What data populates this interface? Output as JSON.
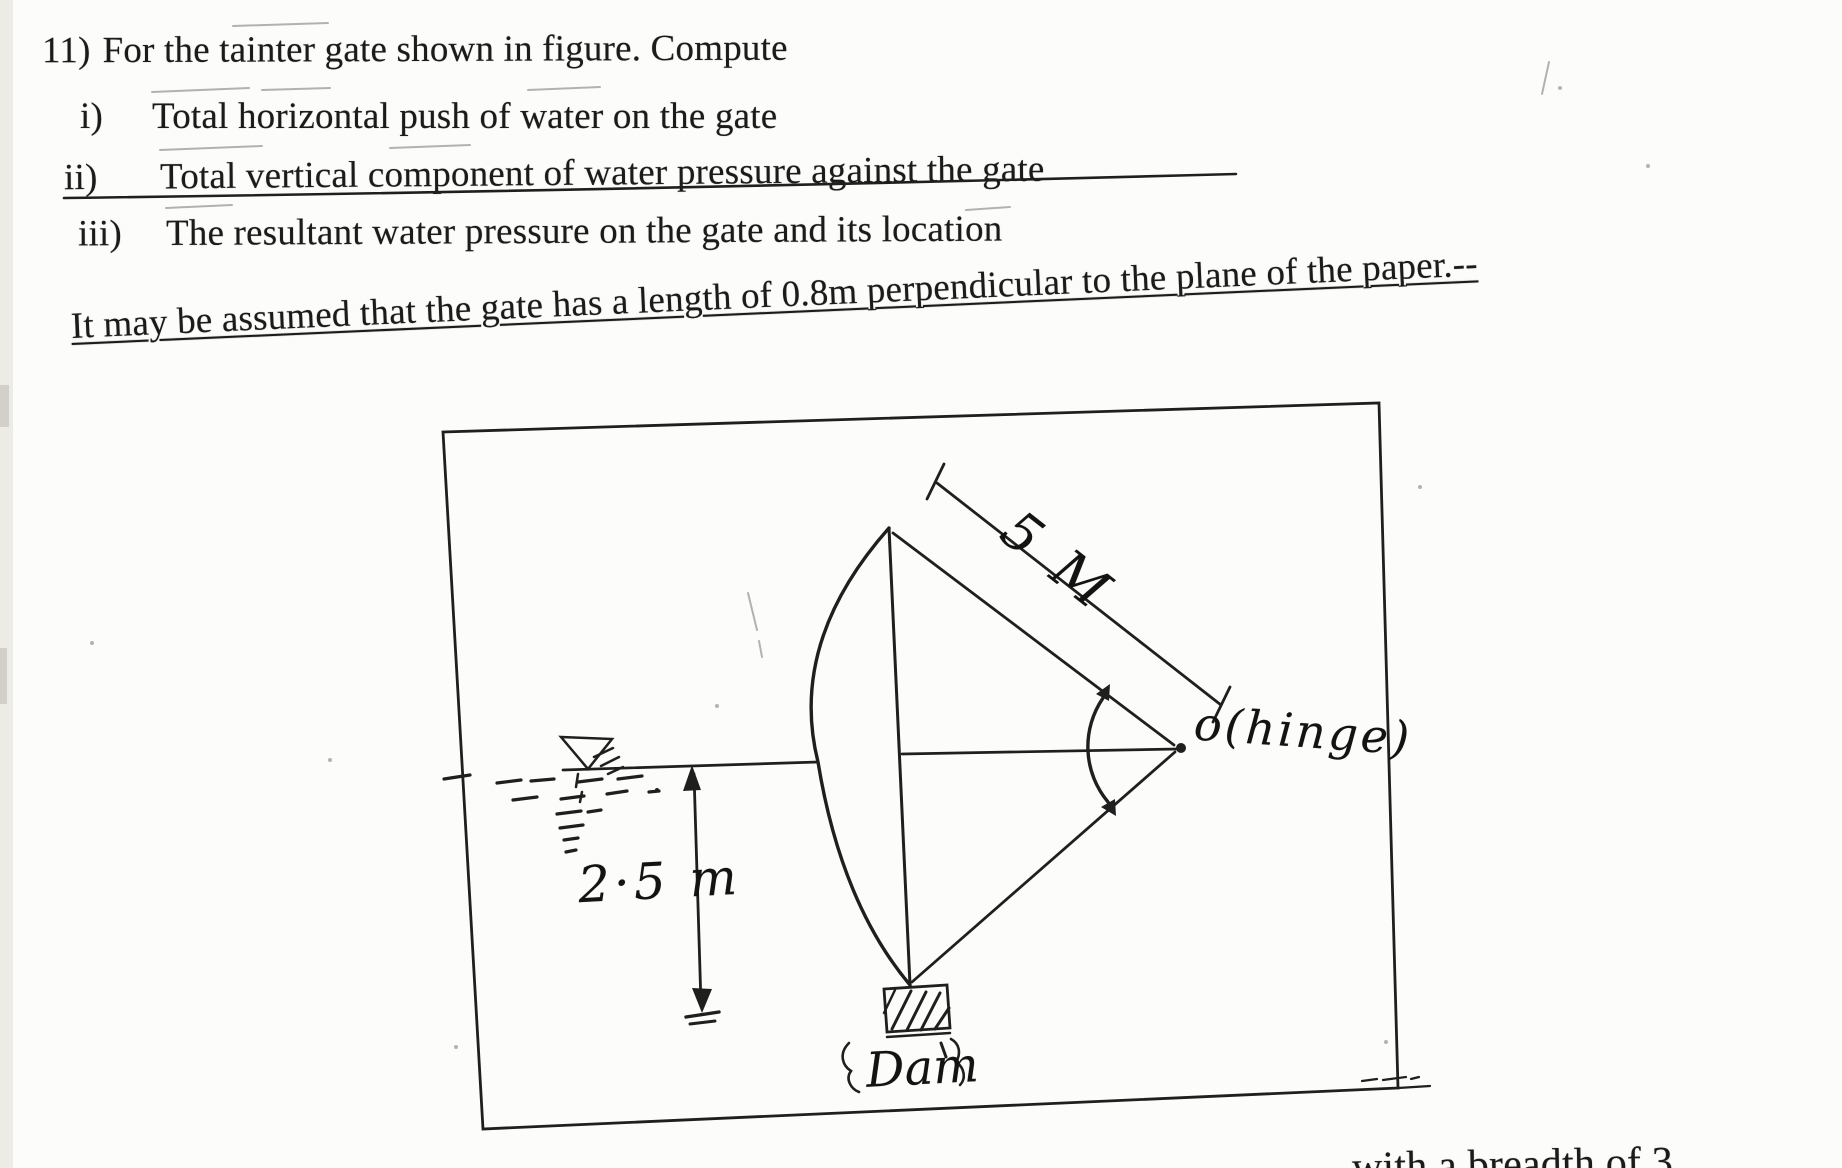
{
  "scan": {
    "paper_color": "#fcfcfa",
    "ink_color": "#1b1b1b"
  },
  "problem": {
    "number": "11)",
    "title": "For the tainter gate shown in figure. Compute",
    "items": [
      {
        "label": "i)",
        "text": "Total horizontal push of water on the gate"
      },
      {
        "label": "ii)",
        "text": "Total vertical component of water pressure against the gate"
      },
      {
        "label": "iii)",
        "text": "The resultant water pressure on the gate and its location"
      }
    ],
    "assumption": "It may be assumed that the gate has a length of 0.8m perpendicular to the plane of the paper.--"
  },
  "figure": {
    "radius_label": "5 M",
    "hinge_label": "o(hinge)",
    "depth_label": "2·5 m",
    "dam_label": "Dam"
  },
  "cutoff_next_line": "with a breadth of 3"
}
